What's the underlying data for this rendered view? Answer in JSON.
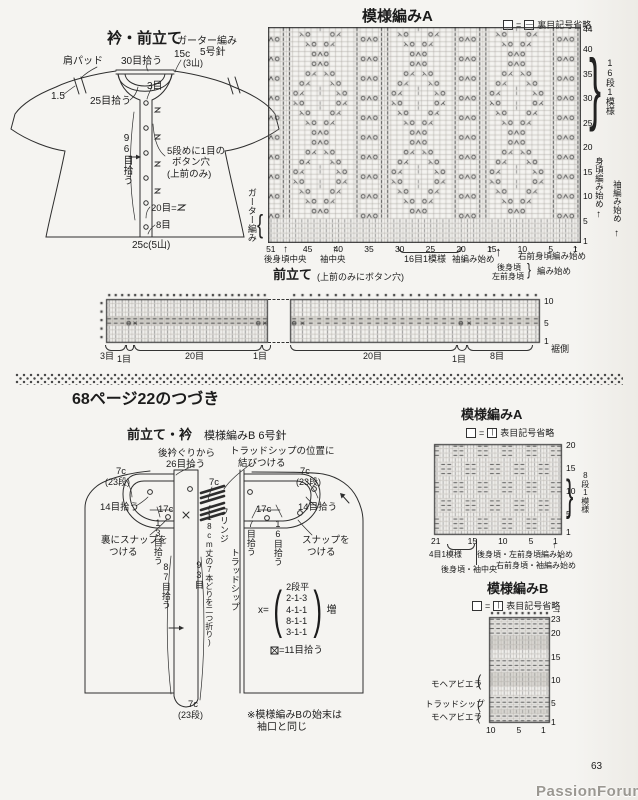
{
  "page": {
    "number": "63",
    "watermark": "PassionForum.ru"
  },
  "glyphs": {
    "up": "↑"
  },
  "top_schematic": {
    "title": "衿・前立て",
    "garter": "ガーター編み",
    "needle": "5号針",
    "shoulder_pad": "肩パッド",
    "pickup_30": "30目拾う",
    "c15": "15c",
    "c15_sub": "(3山)",
    "v1_5": "1.5",
    "pickup_25": "25目拾う",
    "st3": "3目",
    "pickup_96": "96目拾う",
    "bh_note1": "5段めに1目の",
    "bh_note2": "ボタン穴",
    "bh_note3": "(上前のみ)",
    "st20_eq": "20目=",
    "st8": "8目",
    "c25": "25c(5山)"
  },
  "top_chart": {
    "title": "模様編みA",
    "legend_eq": "=",
    "legend_text": "裏目記号省略",
    "garter_label": "ガーター編み",
    "row_ticks": [
      44,
      40,
      35,
      30,
      25,
      20,
      15,
      10,
      5,
      1
    ],
    "col_ticks": [
      51,
      45,
      40,
      35,
      30,
      25,
      20,
      15,
      10,
      5,
      1
    ],
    "row_repeat": "16段1模様",
    "col_repeat": "16目1模様",
    "body_start": "身頃編み始め",
    "sleeve_start_right": "袖編み始め",
    "back_center": "後身頃中央",
    "sleeve_center": "袖中央",
    "sleeve_start_bottom": "袖編み始め",
    "back_body": "後身頃",
    "left_front": "左前身頃",
    "knit_start": "編み始め",
    "right_front_start": "右前身頃編み始め"
  },
  "placket_band": {
    "title": "前立て",
    "subtitle": "(上前のみにボタン穴)",
    "left_groups": [
      "3目",
      "1目",
      "20目",
      "1目"
    ],
    "right_groups": [
      "20目",
      "1目",
      "8目"
    ],
    "hem_side": "裾側",
    "row_ticks": [
      10,
      5,
      1
    ]
  },
  "continuation": {
    "heading": "68ページ22のつづき",
    "sub1": "前立て・衿",
    "sub2": "模様編みB 6号針"
  },
  "bottom_schematic": {
    "neck1": "後衿ぐりから",
    "neck2": "26目拾う",
    "trad1": "トラッドシップの位置に",
    "trad2": "結びつける",
    "c7": "7c",
    "c7_rows": "(23段)",
    "pickup_14": "14目拾う",
    "c17": "17c",
    "pickup_13": "13目拾う",
    "pickup_7": "7目拾う",
    "pickup_16": "16目拾う",
    "snap_back1": "裏にスナップを",
    "snap_back2": "つける",
    "snap1": "スナップを",
    "snap2": "つける",
    "fringe": "フリンジ",
    "fringe_note": "(18cm丈の7本どりを二つ折り)",
    "tradship": "トラッドシップ",
    "pickup_87": "87目拾う",
    "st93": "93目",
    "x_label": "x=",
    "x_lines": [
      "2段平",
      "2-1-3",
      "4-1-1",
      "8-1-1",
      "3-1-1"
    ],
    "x_inc": "増",
    "mark_eq": "=11目拾う",
    "note1": "※模様編みBの始末は",
    "note2": "袖口と同じ"
  },
  "chart_a": {
    "title": "模様編みA",
    "legend_eq": "=",
    "legend_text": "表目記号省略",
    "row_ticks": [
      20,
      15,
      10,
      5,
      1
    ],
    "col_ticks": [
      21,
      15,
      10,
      5,
      1
    ],
    "row_repeat": "8段1模様",
    "col_repeat": "4目1模様",
    "center": "後身頃・袖中央",
    "start1": "後身頃・左前身頃編み始め",
    "start2": "右前身頃・袖編み始め"
  },
  "chart_b": {
    "title": "模様編みB",
    "legend_eq": "=",
    "legend_text": "表目記号省略",
    "row_ticks": [
      23,
      20,
      15,
      10,
      5,
      1
    ],
    "col_ticks": [
      10,
      5,
      1
    ],
    "yarn_top": "モヘアビエラ",
    "yarn_mid": "トラッドシップ",
    "yarn_bottom": "モヘアビエラ",
    "direction_arrow": "→"
  },
  "grids": {
    "top": {
      "cols": 51,
      "rows": 44,
      "garter_rows": 5,
      "motif": [
        "!OXO!..........!",
        "!...!....OXO...!",
        "!...!..........!",
        "!...!...AO.OY..!",
        "!OXO!..........!",
        "!...!..AO...OY.!",
        "!...!.....l....!",
        "!...!.AO..l..OY!",
        "!OXO!..........!",
        "!...!.OY..l..AO!",
        "!...!.....l....!",
        "!...!..OY...AO.!",
        "!OXO!..........!",
        "!...!...OY.AO..!",
        "!...!..........!",
        "!...!....OXO...!"
      ]
    },
    "strip_left": {
      "cols": 25,
      "rows": 10,
      "shaded_rows": [
        5,
        6
      ],
      "buttonholes": [
        4,
        24
      ],
      "edge_dots": true
    },
    "strip_right": {
      "cols": 30,
      "rows": 10,
      "shaded_rows": [
        5,
        6
      ],
      "buttonholes": [
        1,
        21
      ],
      "edge_dots": false
    },
    "blocks": {
      "cols": 21,
      "rows": 20
    },
    "bands": {
      "cols": 10,
      "rows": 23,
      "dash_rows": [
        1,
        2,
        4,
        5,
        6,
        12,
        13,
        14,
        20,
        21,
        22,
        23
      ],
      "shaded_rows": [
        3,
        9,
        10,
        11,
        17,
        18,
        19
      ]
    }
  }
}
